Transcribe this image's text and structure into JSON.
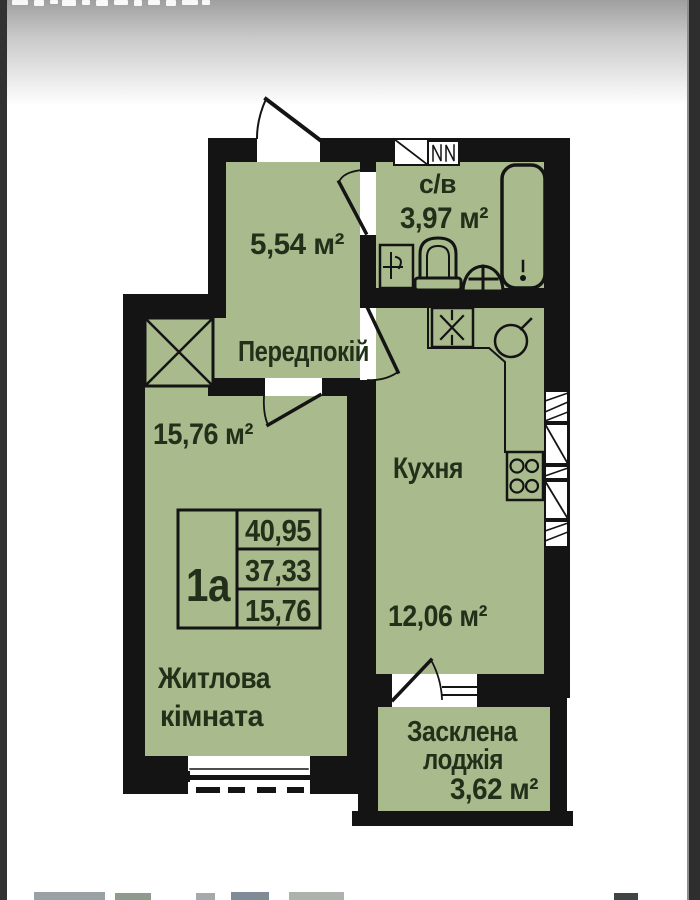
{
  "plan": {
    "unit": {
      "label": "1а",
      "table_values": [
        "40,95",
        "37,33",
        "15,76"
      ]
    },
    "rooms": {
      "hallway": {
        "name": "Передпокій",
        "area": "5,54 м²"
      },
      "bathroom": {
        "name": "с/в",
        "area": "3,97 м²"
      },
      "kitchen": {
        "name": "Кухня",
        "area": "12,06 м²"
      },
      "living": {
        "name_lines": [
          "Житлова",
          "кімната"
        ],
        "area": "15,76 м²"
      },
      "loggia": {
        "name_lines": [
          "Засклена",
          "лоджія"
        ],
        "area": "3,62 м²"
      }
    },
    "colors": {
      "room_fill": "#a9ba8d",
      "wall_ink": "#141414",
      "label_ink": "#22301a"
    }
  }
}
